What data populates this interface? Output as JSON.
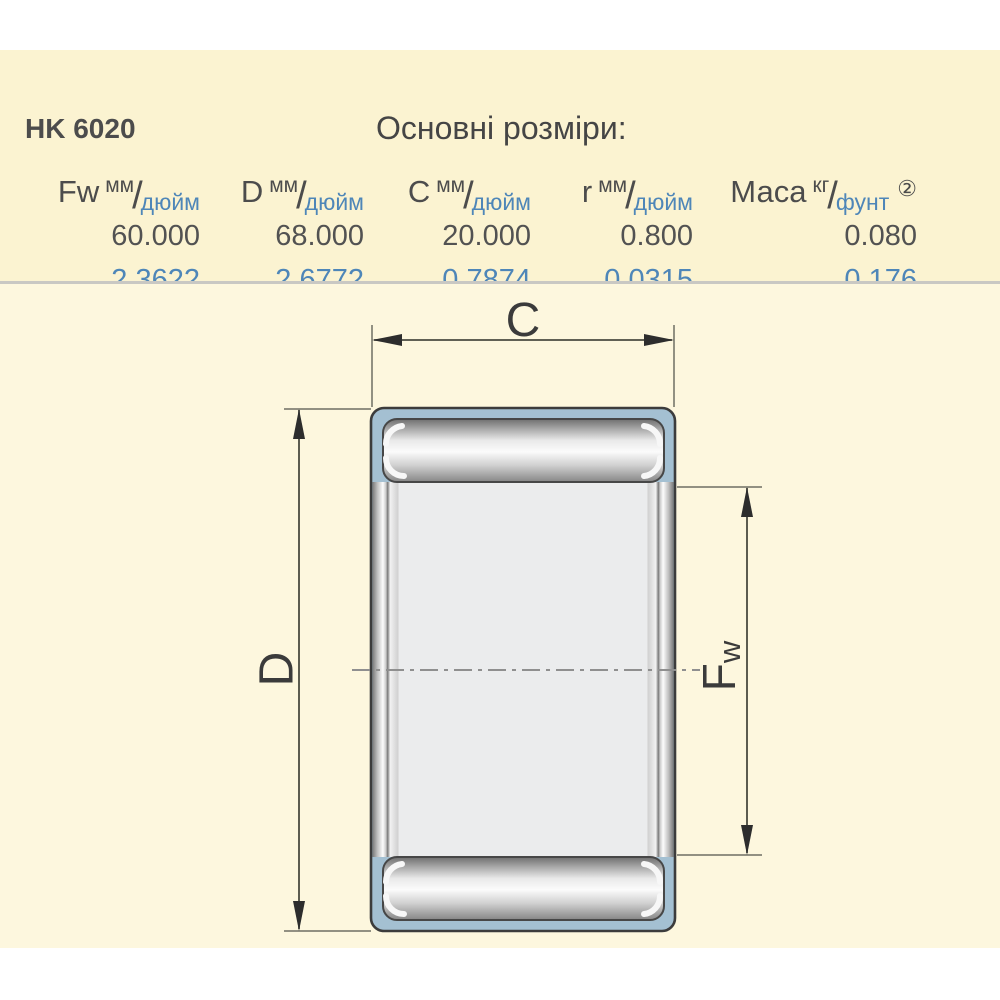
{
  "page": {
    "product_code": "HK 6020",
    "section_title": "Основні розміри:"
  },
  "table": {
    "unit_separator": "/",
    "columns": [
      {
        "symbol": "Fw",
        "unit_top": "мм",
        "unit_bottom": "дюйм",
        "mm": "60.000",
        "inch": "2.3622"
      },
      {
        "symbol": "D",
        "unit_top": "мм",
        "unit_bottom": "дюйм",
        "mm": "68.000",
        "inch": "2.6772"
      },
      {
        "symbol": "C",
        "unit_top": "мм",
        "unit_bottom": "дюйм",
        "mm": "20.000",
        "inch": "0.7874"
      },
      {
        "symbol": "r",
        "unit_top": "мм",
        "unit_bottom": "дюйм",
        "mm": "0.800",
        "inch": "0.0315"
      },
      {
        "symbol": "Маса",
        "unit_top": "кг",
        "unit_bottom": "фунт",
        "note": "②",
        "mm": "0.080",
        "inch": "0.176"
      }
    ]
  },
  "diagram": {
    "labels": {
      "c": "C",
      "d": "D",
      "fw_main": "F",
      "fw_sub": "w"
    }
  },
  "colors": {
    "accent_blue": "#4e86b8",
    "text_dark": "#4c4c4c",
    "shell_blue": "#a4c0d2",
    "panel_cream": "#fbf3d1",
    "drawing_cream": "#fdf7de"
  }
}
